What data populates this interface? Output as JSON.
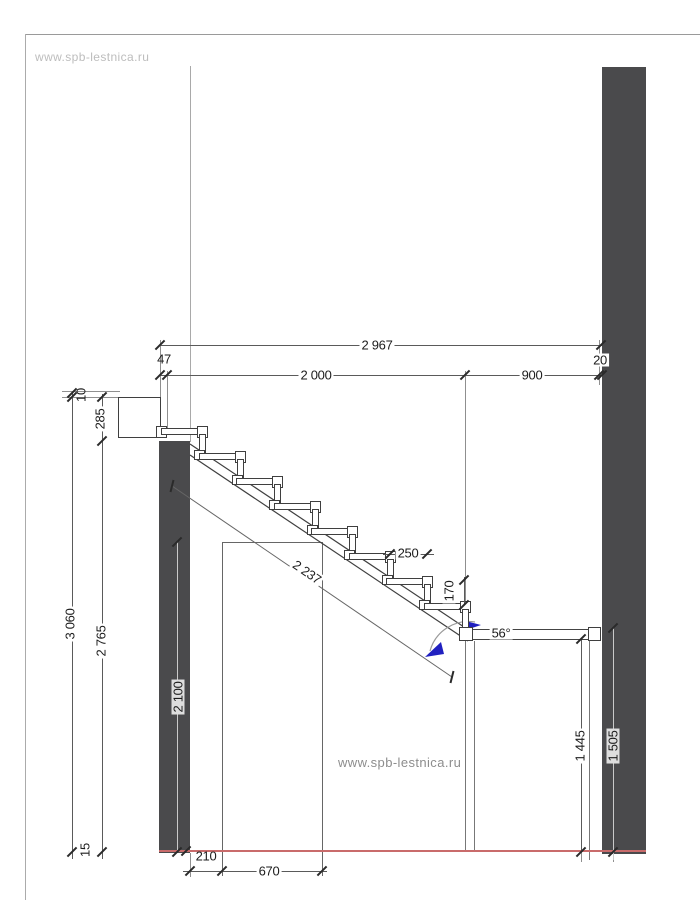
{
  "watermarks": {
    "top": "www.spb-lestnica.ru",
    "center": "www.spb-lestnica.ru"
  },
  "dimensions": {
    "total_width": "2 967",
    "left_offset": "47",
    "stair_run": "2 000",
    "landing_width": "900",
    "wall_gap": "20",
    "top_offset": "10",
    "slab_thickness": "285",
    "total_height": "3 060",
    "height_under_slab": "2 765",
    "clear_passage_height": "2 100",
    "floor_finish": "15",
    "tread_depth": "250",
    "riser_height": "170",
    "stringer_length": "2 237",
    "stair_angle": "56°",
    "bottom_offset": "210",
    "passage_width": "670",
    "lower_clear_height": "1 445",
    "lower_floor_height": "1 505"
  },
  "colors": {
    "wall_fill": "#4a4a4c",
    "red_baseline": "#c96b6b",
    "angle_arrow_blue": "#2020c0",
    "line": "#5a5a5a"
  }
}
